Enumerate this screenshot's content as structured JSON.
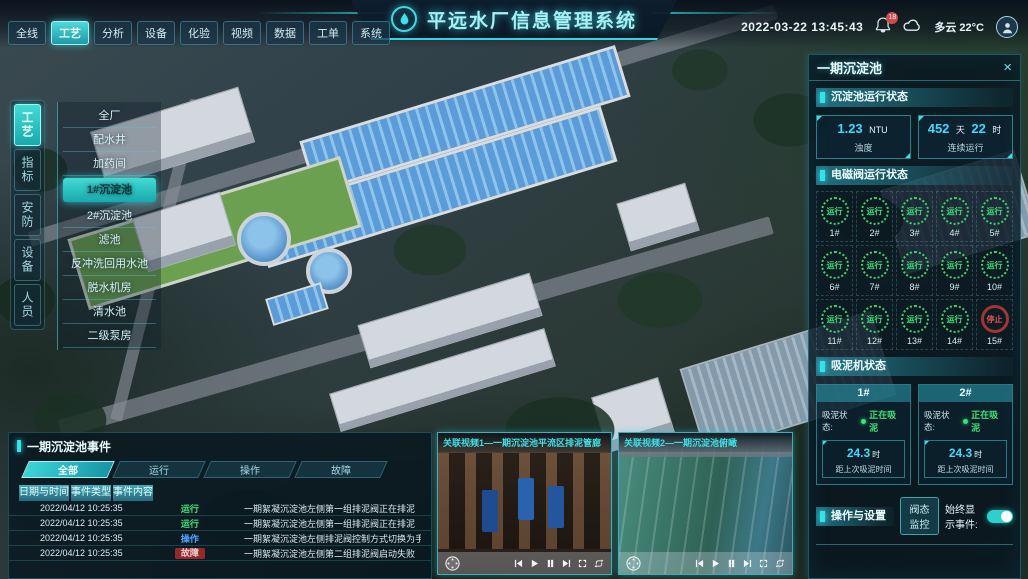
{
  "header": {
    "title": "平远水厂信息管理系统",
    "nav": [
      {
        "label": "全线"
      },
      {
        "label": "工艺",
        "active": true
      },
      {
        "label": "分析"
      },
      {
        "label": "设备"
      },
      {
        "label": "化验"
      },
      {
        "label": "视频"
      },
      {
        "label": "数据"
      },
      {
        "label": "工单"
      },
      {
        "label": "系统"
      }
    ],
    "datetime": "2022-03-22 13:45:43",
    "bell_badge": "18",
    "weather": "多云 22°C",
    "icons": [
      "water-drop-logo",
      "bell-icon",
      "cloud-icon",
      "user-avatar-icon"
    ]
  },
  "sidebar": {
    "tabs": [
      {
        "label": "工艺",
        "active": true
      },
      {
        "label": "指标"
      },
      {
        "label": "安防"
      },
      {
        "label": "设备"
      },
      {
        "label": "人员"
      }
    ]
  },
  "process_menu": {
    "items": [
      {
        "label": "全厂"
      },
      {
        "label": "配水井"
      },
      {
        "label": "加药间"
      },
      {
        "label": "1#沉淀池",
        "active": true
      },
      {
        "label": "2#沉淀池"
      },
      {
        "label": "滤池"
      },
      {
        "label": "反冲洗回用水池"
      },
      {
        "label": "脱水机房"
      },
      {
        "label": "清水池"
      },
      {
        "label": "二级泵房"
      }
    ]
  },
  "right_panel": {
    "title": "一期沉淀池",
    "close_label": "×",
    "running": {
      "title": "沉淀池运行状态",
      "turbidity": {
        "value": "1.23",
        "unit": "NTU",
        "label": "浊度"
      },
      "uptime": {
        "days": "452",
        "days_unit": "天",
        "hours": "22",
        "hours_unit": "时",
        "label": "连续运行"
      }
    },
    "valves": {
      "title": "电磁阀运行状态",
      "items": [
        {
          "id": "1#",
          "status": "运行",
          "state": "run"
        },
        {
          "id": "2#",
          "status": "运行",
          "state": "run"
        },
        {
          "id": "3#",
          "status": "运行",
          "state": "run"
        },
        {
          "id": "4#",
          "status": "运行",
          "state": "run"
        },
        {
          "id": "5#",
          "status": "运行",
          "state": "run"
        },
        {
          "id": "6#",
          "status": "运行",
          "state": "run"
        },
        {
          "id": "7#",
          "status": "运行",
          "state": "run"
        },
        {
          "id": "8#",
          "status": "运行",
          "state": "run"
        },
        {
          "id": "9#",
          "status": "运行",
          "state": "run"
        },
        {
          "id": "10#",
          "status": "运行",
          "state": "run"
        },
        {
          "id": "11#",
          "status": "运行",
          "state": "run"
        },
        {
          "id": "12#",
          "status": "运行",
          "state": "run"
        },
        {
          "id": "13#",
          "status": "运行",
          "state": "run"
        },
        {
          "id": "14#",
          "status": "运行",
          "state": "run"
        },
        {
          "id": "15#",
          "status": "停止",
          "state": "stop"
        }
      ]
    },
    "mud": {
      "title": "吸泥机状态",
      "machines": [
        {
          "id": "1#",
          "status_label": "吸泥状态:",
          "status": "正在吸泥",
          "value": "24.3",
          "unit": "时",
          "label": "距上次吸泥时间"
        },
        {
          "id": "2#",
          "status_label": "吸泥状态:",
          "status": "正在吸泥",
          "value": "24.3",
          "unit": "时",
          "label": "距上次吸泥时间"
        }
      ]
    },
    "ops": {
      "title": "操作与设置",
      "button": "阀态监控",
      "toggle_label": "始终显示事件:",
      "toggle_on": true
    }
  },
  "events": {
    "title": "一期沉淀池事件",
    "tabs": [
      {
        "label": "全部",
        "active": true
      },
      {
        "label": "运行"
      },
      {
        "label": "操作"
      },
      {
        "label": "故障"
      }
    ],
    "columns": [
      {
        "label": "日期与时间"
      },
      {
        "label": "事件类型"
      },
      {
        "label": "事件内容"
      }
    ],
    "rows": [
      {
        "datetime": "2022/04/12 10:25:35",
        "type": "运行",
        "type_class": "t-run",
        "content": "一期絮凝沉淀池左侧第一组排泥阀正在排泥"
      },
      {
        "datetime": "2022/04/12 10:25:35",
        "type": "运行",
        "type_class": "t-run",
        "content": "一期絮凝沉淀池左侧第一组排泥阀正在排泥"
      },
      {
        "datetime": "2022/04/12 10:25:35",
        "type": "操作",
        "type_class": "t-op",
        "content": "一期絮凝沉淀池左侧排泥阀控制方式切换为手动"
      },
      {
        "datetime": "2022/04/12 10:25:35",
        "type": "故障",
        "type_class": "t-fault",
        "content": "一期絮凝沉淀池左侧第二组排泥阀启动失败"
      }
    ]
  },
  "videos": {
    "items": [
      {
        "title": "关联视频1—一期沉淀池平流区排泥管廊",
        "thumb": "thumb-corridor"
      },
      {
        "title": "关联视频2—一期沉淀池俯瞰",
        "thumb": "thumb-pools"
      }
    ],
    "control_icons": [
      "ptz-dpad-icon",
      "skip-back-icon",
      "play-icon",
      "pause-icon",
      "skip-forward-icon",
      "fullscreen-icon",
      "loop-icon"
    ]
  },
  "colors": {
    "accent": "#35e2ea",
    "run_green": "#3fe07a",
    "stop_red": "#d24a4a",
    "op_blue": "#4da6ff",
    "value_cyan": "#41d9ff"
  }
}
